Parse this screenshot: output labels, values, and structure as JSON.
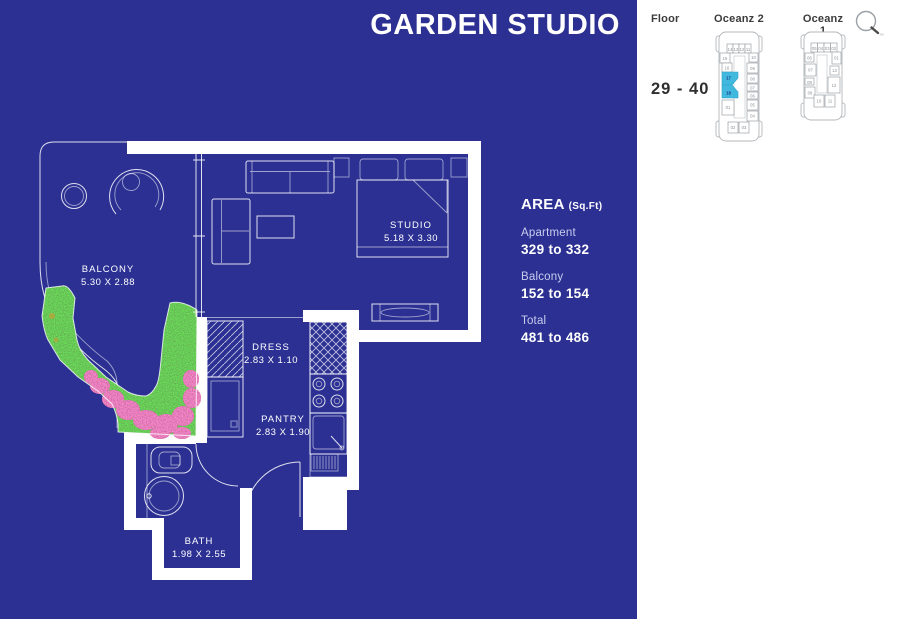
{
  "title": "GARDEN STUDIO",
  "floor_plan": {
    "balcony": {
      "name": "BALCONY",
      "dims": "5.30 X 2.88"
    },
    "studio": {
      "name": "STUDIO",
      "dims": "5.18 X 3.30"
    },
    "dress": {
      "name": "DRESS",
      "dims": "2.83 X 1.10"
    },
    "pantry": {
      "name": "PANTRY",
      "dims": "2.83 X 1.90"
    },
    "bath": {
      "name": "BATH",
      "dims": "1.98 X 2.55"
    }
  },
  "area_panel": {
    "heading": "AREA",
    "unit": "(Sq.Ft)",
    "rows": [
      {
        "label": "Apartment",
        "value": "329 to 332"
      },
      {
        "label": "Balcony",
        "value": "152 to 154"
      },
      {
        "label": "Total",
        "value": "481 to 486"
      }
    ]
  },
  "floor_panel": {
    "floor_label": "Floor",
    "floor_range": "29 - 40",
    "trademark": "™",
    "tower2": {
      "name": "Oceanz 2",
      "top_units": [
        "14",
        "13",
        "12",
        "11"
      ],
      "left_units": [
        "15",
        "16",
        "17",
        "18",
        "01"
      ],
      "right_units": [
        "10",
        "09",
        "08",
        "07",
        "06",
        "05",
        "04"
      ],
      "bottom_units": [
        "02",
        "03"
      ],
      "highlighted_units": [
        "17",
        "18"
      ]
    },
    "tower1": {
      "name": "Oceanz 1",
      "top_units": [
        "05",
        "04",
        "03",
        "02"
      ],
      "left_units": [
        "06",
        "07",
        "08",
        "09"
      ],
      "right_units": [
        "01",
        "13",
        "12"
      ],
      "bottom_units": [
        "10",
        "11"
      ]
    }
  },
  "colors": {
    "background_blue": "#2b3092",
    "highlight_cyan": "#41b8dd",
    "plan_line": "#ffffff",
    "panel_text": "#3b3b3b",
    "foliage_green": "#2c6e2e",
    "flower_pink": "#b23a78"
  }
}
